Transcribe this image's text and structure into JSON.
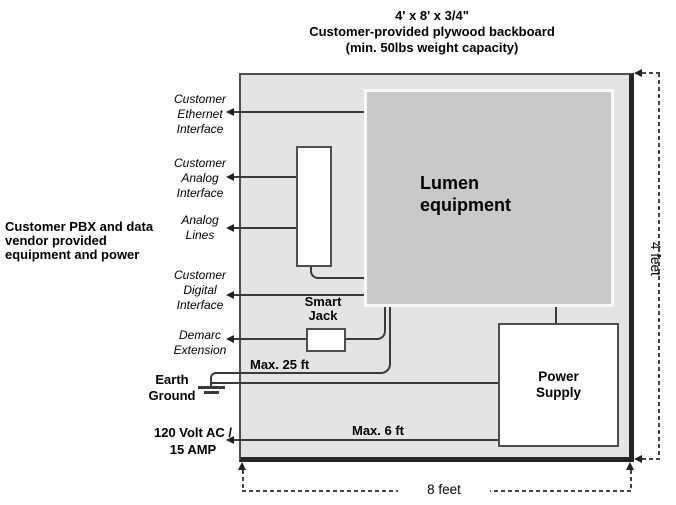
{
  "title": {
    "dimensions": "4' x 8' x 3/4\"",
    "description": "Customer-provided plywood backboard",
    "capacity": "(min. 50lbs weight capacity)"
  },
  "side_note": "Customer PBX and data\nvendor provided\nequipment and power",
  "interfaces": {
    "ethernet": "Customer\nEthernet\nInterface",
    "analog_interface": "Customer\nAnalog\nInterface",
    "analog_lines": "Analog\nLines",
    "digital_interface": "Customer\nDigital\nInterface",
    "demarc_extension": "Demarc\nExtension",
    "earth_ground": "Earth\nGround",
    "power_feed": "120 Volt AC /\n15 AMP"
  },
  "equipment": {
    "lumen": "Lumen\nequipment",
    "smart_jack": "Smart\nJack",
    "power_supply": "Power\nSupply"
  },
  "measurements": {
    "max_ground_cable": "Max. 25 ft",
    "max_power_cable": "Max. 6 ft",
    "board_width": "8 feet",
    "board_height": "4 feet"
  },
  "colors": {
    "backboard_fill": "#e4e4e4",
    "lumen_fill": "#c9c9c9",
    "line": "#3a3a3a"
  }
}
